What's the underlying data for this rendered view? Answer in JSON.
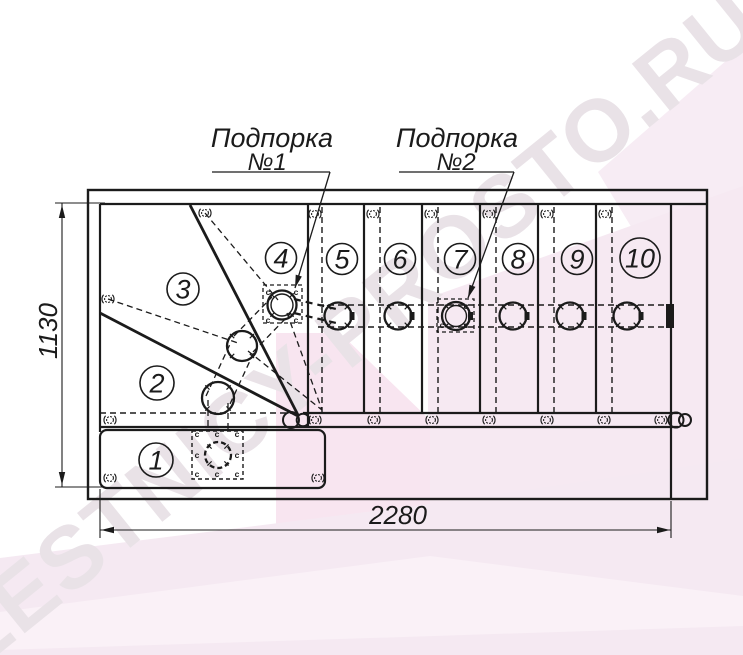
{
  "watermark": {
    "text": "LESTNICY-PROSTO.RU",
    "color": "#e9e2e7"
  },
  "labels": {
    "support1": {
      "line1": "Подпорка",
      "line2": "№1"
    },
    "support2": {
      "line1": "Подпорка",
      "line2": "№2"
    }
  },
  "dimensions": {
    "width": {
      "value": "2280"
    },
    "height": {
      "value": "1130"
    }
  },
  "marks": {
    "connector": "c"
  },
  "steps": [
    {
      "n": "1",
      "x": 156,
      "y": 460,
      "r": 17
    },
    {
      "n": "2",
      "x": 157,
      "y": 383,
      "r": 17
    },
    {
      "n": "3",
      "x": 183,
      "y": 289,
      "r": 16
    },
    {
      "n": "4",
      "x": 281,
      "y": 258,
      "r": 15.5
    },
    {
      "n": "5",
      "x": 342,
      "y": 259,
      "r": 15.5
    },
    {
      "n": "6",
      "x": 400,
      "y": 259,
      "r": 15.5
    },
    {
      "n": "7",
      "x": 460,
      "y": 259,
      "r": 15.5
    },
    {
      "n": "8",
      "x": 518,
      "y": 259,
      "r": 15.5
    },
    {
      "n": "9",
      "x": 577,
      "y": 259,
      "r": 15.5
    },
    {
      "n": "10",
      "x": 640,
      "y": 258,
      "r": 20
    }
  ],
  "colors": {
    "line": "#1b1b1b",
    "pink_light": "#f6e9f2",
    "pink_deep": "#f8e5f0",
    "pink_pale": "#f5e9f2"
  },
  "drawing": {
    "bg": [
      {
        "pts": "598,172 743,46 743,254 650,258",
        "fill": "#f7ecf4"
      },
      {
        "pts": "428,298 743,186 743,560 428,560",
        "fill": "#f6e9f2"
      },
      {
        "pts": "276,333 340,333 430,420 430,560 276,560",
        "fill": "#f8e5f0"
      },
      {
        "pts": "0,558 430,504 743,458 743,655 0,655",
        "fill": "#f5e9f2"
      },
      {
        "pts": "0,612 430,556 743,596 743,626 0,650",
        "fill": "#faf1f7"
      }
    ],
    "rects": [
      {
        "x": 88,
        "y": 190,
        "w": 619,
        "h": 309,
        "sw": 2.4
      },
      {
        "x": 100,
        "y": 430,
        "w": 225,
        "h": 58,
        "rx": 7,
        "sw": 2.2
      },
      {
        "x": 263,
        "y": 285,
        "w": 39,
        "h": 38,
        "sw": 1.3,
        "da": "4 3"
      },
      {
        "x": 437,
        "y": 299,
        "w": 37,
        "h": 33,
        "sw": 1.3,
        "da": "4 3"
      },
      {
        "x": 192,
        "y": 431,
        "w": 51,
        "h": 48,
        "sw": 1.4,
        "da": "4 3"
      }
    ],
    "lines": [
      [
        100,
        204,
        707,
        204,
        2.2
      ],
      [
        100,
        204,
        100,
        432,
        2.2
      ],
      [
        671,
        204,
        671,
        499,
        2.2
      ],
      [
        308,
        204,
        308,
        427,
        2.2
      ],
      [
        364,
        204,
        364,
        413,
        2.2
      ],
      [
        422,
        204,
        422,
        413,
        2.2
      ],
      [
        480,
        204,
        480,
        413,
        2.2
      ],
      [
        538,
        204,
        538,
        413,
        2.2
      ],
      [
        596,
        204,
        596,
        413,
        2.2
      ],
      [
        303,
        413,
        678,
        413,
        2.2
      ],
      [
        100,
        427,
        678,
        427,
        2.2
      ],
      [
        190,
        205,
        298,
        415,
        2.8
      ],
      [
        100,
        313,
        298,
        416,
        2.8
      ],
      [
        55,
        203,
        105,
        203,
        1.1
      ],
      [
        55,
        487,
        105,
        487,
        1.1
      ],
      [
        62,
        203,
        62,
        487,
        1.1
      ],
      [
        100,
        489,
        100,
        538,
        1.1
      ],
      [
        671,
        501,
        671,
        538,
        1.1
      ],
      [
        100,
        530,
        671,
        530,
        1.1
      ],
      [
        212,
        172,
        330,
        172,
        1.3
      ],
      [
        330,
        172,
        295,
        288,
        1.3
      ],
      [
        399,
        172,
        514,
        172,
        1.3
      ],
      [
        514,
        172,
        468,
        298,
        1.3
      ]
    ],
    "dashed": [
      [
        100,
        413,
        298,
        413,
        1.4
      ],
      [
        318,
        305,
        668,
        305,
        1.4
      ],
      [
        318,
        327,
        668,
        327,
        1.4
      ],
      [
        322,
        207,
        322,
        413,
        1.4
      ],
      [
        380,
        207,
        380,
        413,
        1.4
      ],
      [
        438,
        207,
        438,
        413,
        1.4
      ],
      [
        496,
        207,
        496,
        413,
        1.4
      ],
      [
        554,
        207,
        554,
        413,
        1.4
      ],
      [
        612,
        207,
        612,
        413,
        1.4
      ],
      [
        208,
        400,
        208,
        431,
        1.3
      ],
      [
        228,
        403,
        228,
        431,
        1.3
      ],
      [
        205,
        213,
        278,
        300,
        1.3
      ],
      [
        287,
        313,
        322,
        410,
        1.3
      ],
      [
        108,
        299,
        238,
        343,
        1.3
      ],
      [
        248,
        351,
        322,
        410,
        1.3
      ],
      [
        206,
        396,
        231,
        342,
        1.3
      ],
      [
        230,
        404,
        255,
        350,
        1.3
      ],
      [
        234,
        336,
        272,
        297,
        1.3
      ],
      [
        253,
        352,
        291,
        313,
        1.3
      ],
      [
        294,
        299,
        336,
        309,
        2.2,
        "7 5"
      ],
      [
        294,
        313,
        336,
        323,
        2.2,
        "7 5"
      ]
    ],
    "fills": [
      [
        666,
        304,
        8,
        24
      ]
    ],
    "posts": [
      {
        "x": 338,
        "y": 316,
        "r": 13.5,
        "tab": 1
      },
      {
        "x": 398,
        "y": 316,
        "r": 13.5,
        "tab": 1
      },
      {
        "x": 456,
        "y": 316,
        "r": 14,
        "i": 10.5,
        "tab": 1
      },
      {
        "x": 513,
        "y": 316,
        "r": 13.5,
        "tab": 1
      },
      {
        "x": 570,
        "y": 316,
        "r": 13.5,
        "tab": 1
      },
      {
        "x": 627,
        "y": 316,
        "r": 13.5,
        "tab": 1
      },
      {
        "x": 282,
        "y": 305,
        "r": 14.5,
        "i": 11
      },
      {
        "x": 242,
        "y": 346,
        "r": 15
      },
      {
        "x": 218,
        "y": 398,
        "r": 16
      },
      {
        "x": 218,
        "y": 455,
        "r": 13,
        "d": 1
      }
    ],
    "caps": [
      [
        291,
        420,
        8
      ],
      [
        303,
        420,
        6.3
      ],
      [
        676,
        420,
        7.5
      ],
      [
        685,
        420,
        6
      ]
    ],
    "balusters": [
      [
        315,
        214
      ],
      [
        373,
        214
      ],
      [
        431,
        214
      ],
      [
        489,
        214
      ],
      [
        547,
        214
      ],
      [
        605,
        214
      ],
      [
        205,
        213
      ],
      [
        108,
        299
      ],
      [
        110,
        420
      ],
      [
        315,
        420
      ],
      [
        374,
        420
      ],
      [
        432,
        420
      ],
      [
        489,
        420
      ],
      [
        547,
        420
      ],
      [
        604,
        420
      ],
      [
        661,
        420
      ],
      [
        110,
        478
      ],
      [
        318,
        478
      ]
    ],
    "cmarks": [
      [
        268,
        295
      ],
      [
        296,
        295
      ],
      [
        268,
        323
      ],
      [
        296,
        323
      ],
      [
        466,
        309
      ],
      [
        442,
        328
      ],
      [
        466,
        328
      ],
      [
        197,
        437
      ],
      [
        217,
        437
      ],
      [
        237,
        437
      ],
      [
        197,
        458
      ],
      [
        237,
        458
      ],
      [
        197,
        477
      ],
      [
        217,
        477
      ],
      [
        237,
        477
      ]
    ],
    "arrows": [
      [
        62,
        205,
        -90
      ],
      [
        62,
        485,
        90
      ],
      [
        101,
        530,
        180
      ],
      [
        670,
        530,
        0
      ],
      [
        295,
        288,
        107
      ],
      [
        468,
        298,
        110
      ]
    ]
  }
}
